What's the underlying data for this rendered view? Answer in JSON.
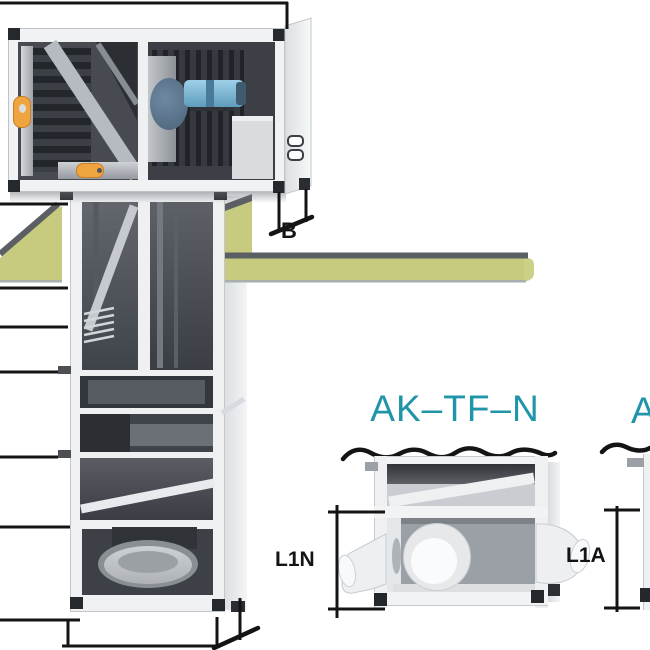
{
  "diagram": {
    "description": "Cutaway illustration of a rooftop air-handling unit on a vertical duct casing passing through a roof slab, with two roof-duct adapter detail views",
    "labels": {
      "top_unit_depth_dim": "B",
      "detail_left_title": "AK–TF–N",
      "detail_left_height_dim": "L1N",
      "detail_right_height_dim": "L1A",
      "detail_right_title_partial": "A"
    },
    "colors": {
      "roof_insulation_green": "#c6cb80",
      "roof_edge_dark": "#5b5f64",
      "title_teal": "#2094a9",
      "handle_orange": "#f0a43f",
      "motor_blue": "#8ec6e0",
      "interior_dark": "#3c4046",
      "frame_white": "#f0f2f4",
      "dimension_line": "#141414"
    }
  }
}
